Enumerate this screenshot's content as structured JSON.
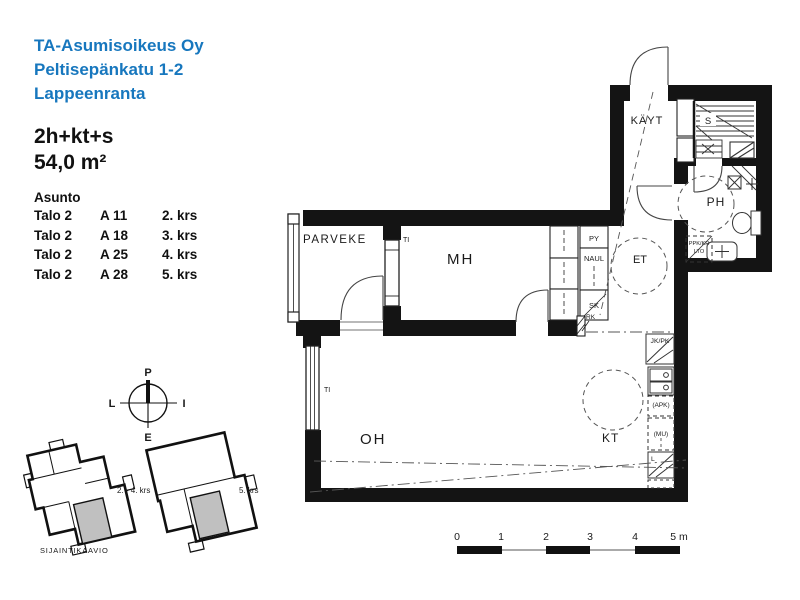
{
  "colors": {
    "brand_blue": "#1777BE",
    "apartment_fill": "#c0c0c0",
    "wall": "#141414"
  },
  "header": {
    "line1": "TA-Asumisoikeus Oy",
    "line2": "Peltisepänkatu 1-2",
    "line3": "Lappeenranta"
  },
  "apartment": {
    "layout": "2h+kt+s",
    "area": "54,0 m²"
  },
  "unit_table": {
    "title": "Asunto",
    "rows": [
      {
        "building": "Talo 2",
        "unit": "A 11",
        "floor": "2. krs"
      },
      {
        "building": "Talo 2",
        "unit": "A 18",
        "floor": "3. krs"
      },
      {
        "building": "Talo 2",
        "unit": "A 25",
        "floor": "4. krs"
      },
      {
        "building": "Talo 2",
        "unit": "A 28",
        "floor": "5. krs"
      }
    ]
  },
  "compass": {
    "north": "P",
    "south": "E",
    "west": "L",
    "east": "I"
  },
  "location": {
    "label_floors_2_4": "2. - 4. krs",
    "label_floor_5": "5. krs",
    "caption": "SIJAINTIKAAVIO"
  },
  "rooms": {
    "balcony": "PARVEKE",
    "bedroom": "MH",
    "living_room": "OH",
    "entry": "ET",
    "kitchen": "KT",
    "corridor": "KÄYT",
    "sauna": "S",
    "bathroom": "PH"
  },
  "fixtures": {
    "drying_cabinet": "PY",
    "coat_rack": "NAUL",
    "cleaning_closet": "SK",
    "electrical_panel": "RK",
    "supply_air": "TI",
    "fridge_freezer": "JK/PK",
    "dishwasher_reservation": "(APK)",
    "microwave_reservation": "(MU)",
    "stove": "L",
    "washer_dryer_reservation": "PPK/KR",
    "heat_recovery": "LTO"
  },
  "scale_bar": {
    "t0": "0",
    "t1": "1",
    "t2": "2",
    "t3": "3",
    "t4": "4",
    "t5": "5 m"
  }
}
